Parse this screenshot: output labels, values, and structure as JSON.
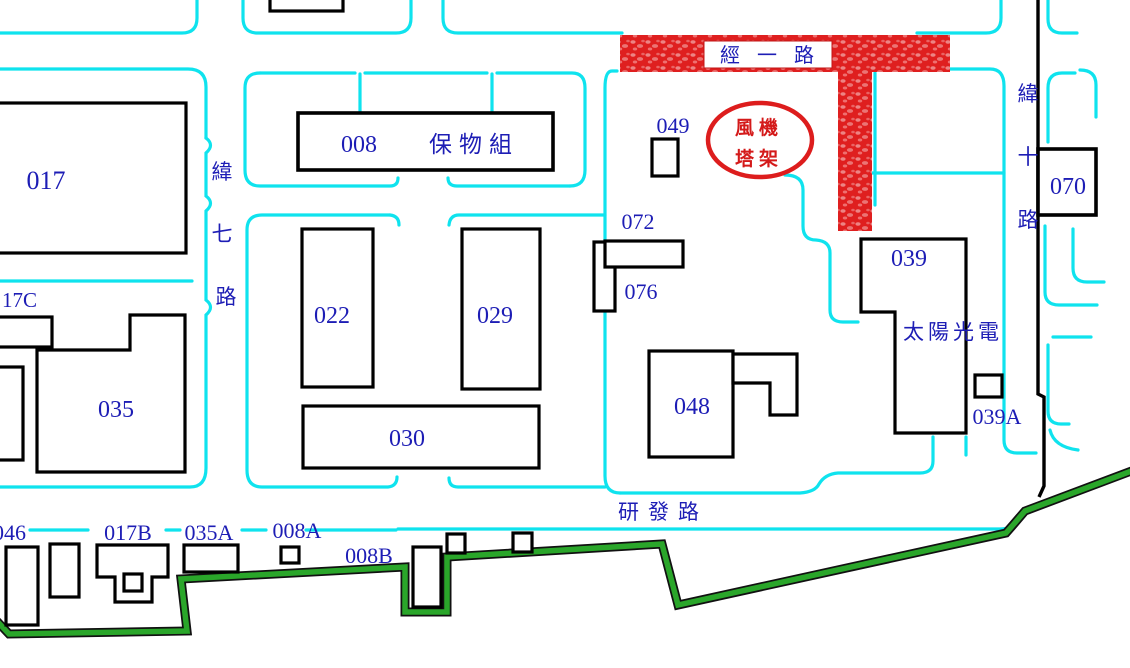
{
  "title": "campus-building-map",
  "colors": {
    "road_curb_cyan": "#0fe3ee",
    "building_outline_black": "#000000",
    "label_blue": "#1d1db5",
    "highlight_red": "#df1f1f",
    "boundary_green": "#2aa62a"
  },
  "roads": {
    "jing_yi_lu": "經 一 路",
    "wei_qi_lu": [
      "緯",
      "七",
      "路"
    ],
    "wei_shi_lu": [
      "緯",
      "十",
      "路"
    ],
    "yan_fa_lu": "研發路"
  },
  "annotation": {
    "wind_turbine_line1": "風機",
    "wind_turbine_line2": "塔架"
  },
  "buildings": {
    "b017": "017",
    "b008": "008",
    "b008_name": "保物組",
    "b049": "049",
    "b072": "072",
    "b076": "076",
    "b022": "022",
    "b029": "029",
    "b030": "030",
    "b035": "035",
    "b048": "048",
    "b039": "039",
    "b039_name": "太陽光電",
    "b039A": "039A",
    "b070": "070",
    "b17C": "17C",
    "b046": "046",
    "b017B": "017B",
    "b035A": "035A",
    "b008A": "008A",
    "b008B": "008B"
  }
}
